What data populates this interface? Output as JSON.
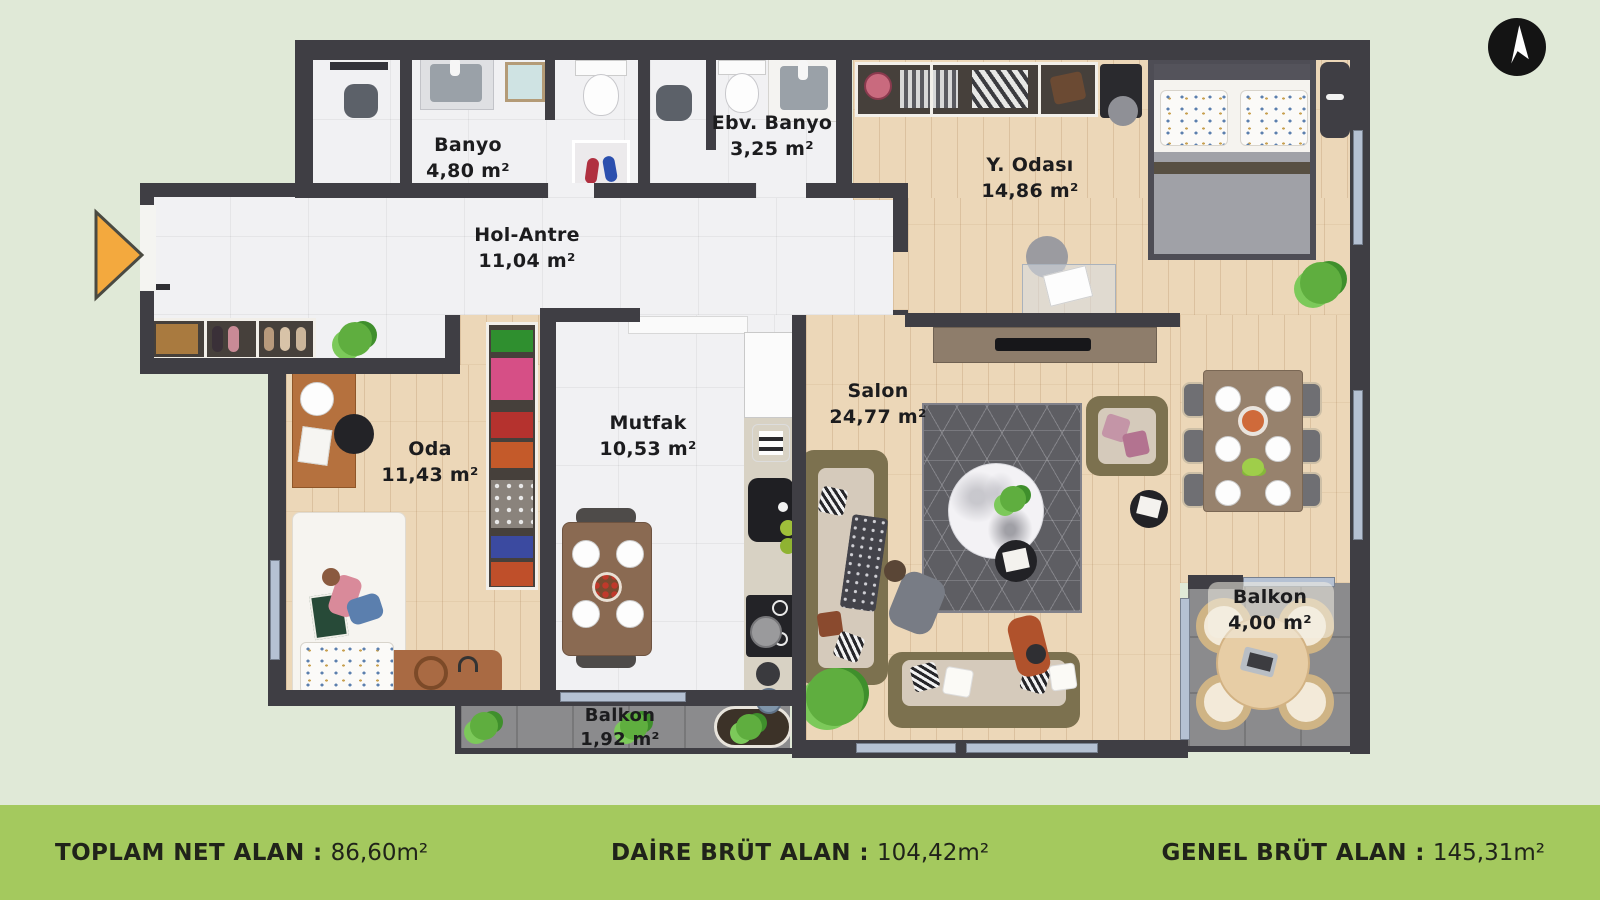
{
  "page": {
    "type": "apartment-floor-plan-render",
    "background": "#e0e9d7"
  },
  "north_arrow": {
    "icon": "navigation-arrow",
    "fill": "#141414",
    "glyph_color": "#ffffff"
  },
  "entrance_marker": {
    "icon": "entrance-triangle",
    "color": "#f3a93e"
  },
  "rooms": [
    {
      "name": "Banyo",
      "area": "4,80 m²"
    },
    {
      "name": "Ebv. Banyo",
      "area": "3,25 m²"
    },
    {
      "name": "Y. Odası",
      "area": "14,86 m²"
    },
    {
      "name": "Hol-Antre",
      "area": "11,04 m²"
    },
    {
      "name": "Oda",
      "area": "11,43 m²"
    },
    {
      "name": "Mutfak",
      "area": "10,53 m²"
    },
    {
      "name": "Salon",
      "area": "24,77 m²"
    },
    {
      "name": "Balkon",
      "area": "1,92 m²"
    },
    {
      "name": "Balkon",
      "area": "4,00 m²"
    }
  ],
  "footer": {
    "bar_color": "#a4c95e",
    "text_color": "#20231a",
    "items": [
      {
        "label": "TOPLAM NET ALAN :",
        "value": "86,60m²"
      },
      {
        "label": "DAİRE BRÜT ALAN :",
        "value": "104,42m²"
      },
      {
        "label": "GENEL BRÜT ALAN :",
        "value": "145,31m²"
      }
    ]
  },
  "colors": {
    "wall": "#3f3e44",
    "tile_floor": "#f1f1f3",
    "wood_floor": "#ecd7b8",
    "balcony_tile": "#8b8b8d",
    "window": "#b5c1d3",
    "label_text": "#1c1c1e"
  }
}
